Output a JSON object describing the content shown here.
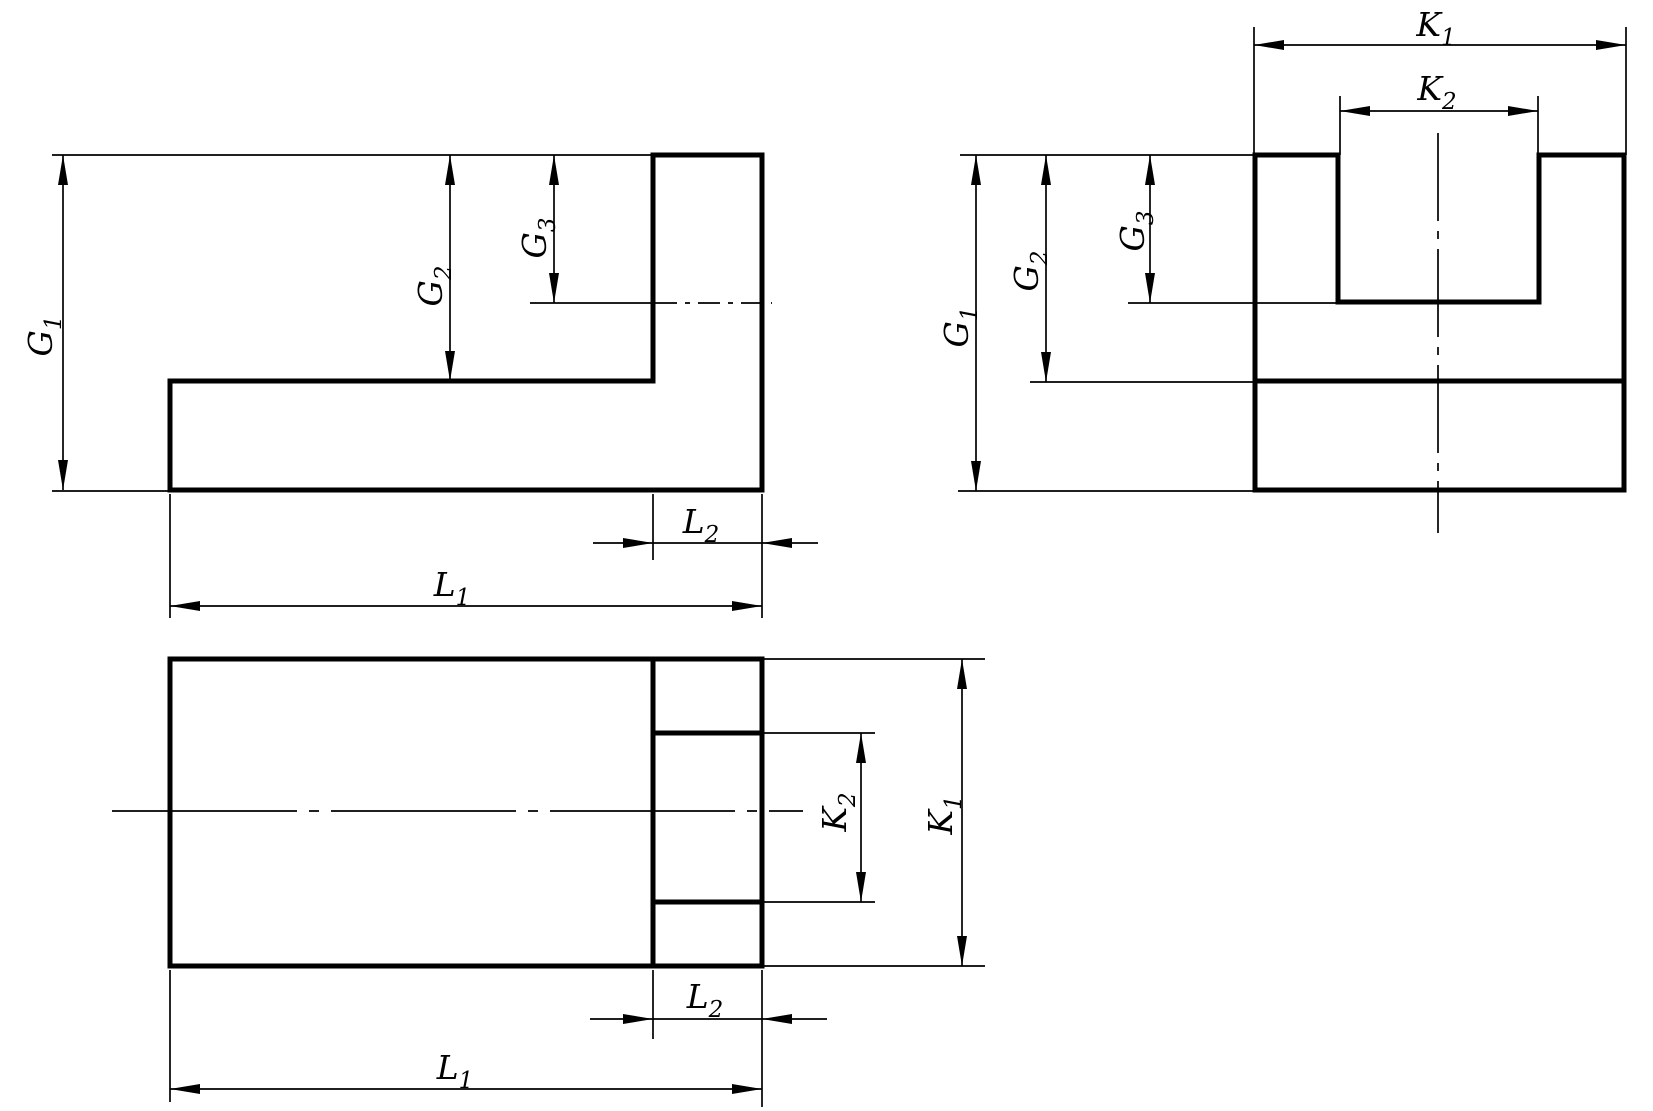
{
  "colors": {
    "background": "#ffffff",
    "line": "#000000"
  },
  "labels": {
    "G1": {
      "base": "G",
      "sub": "1"
    },
    "G2": {
      "base": "G",
      "sub": "2"
    },
    "G3": {
      "base": "G",
      "sub": "3"
    },
    "K1": {
      "base": "K",
      "sub": "1"
    },
    "K2": {
      "base": "K",
      "sub": "2"
    },
    "L1": {
      "base": "L",
      "sub": "1"
    },
    "L2": {
      "base": "L",
      "sub": "2"
    }
  },
  "views": {
    "side_view": {
      "position": "top-left",
      "shape": "L-profile with slot centerline",
      "dimension_ids": [
        "G1",
        "G2",
        "G3",
        "L2",
        "L1"
      ]
    },
    "front_view": {
      "position": "top-right",
      "shape": "U-block with top slot",
      "dimension_ids": [
        "K1",
        "K2",
        "G1",
        "G2",
        "G3"
      ]
    },
    "plan_view": {
      "position": "bottom",
      "shape": "rectangle with leg and slot edges",
      "dimension_ids": [
        "K2",
        "K1",
        "L2",
        "L1"
      ]
    }
  }
}
